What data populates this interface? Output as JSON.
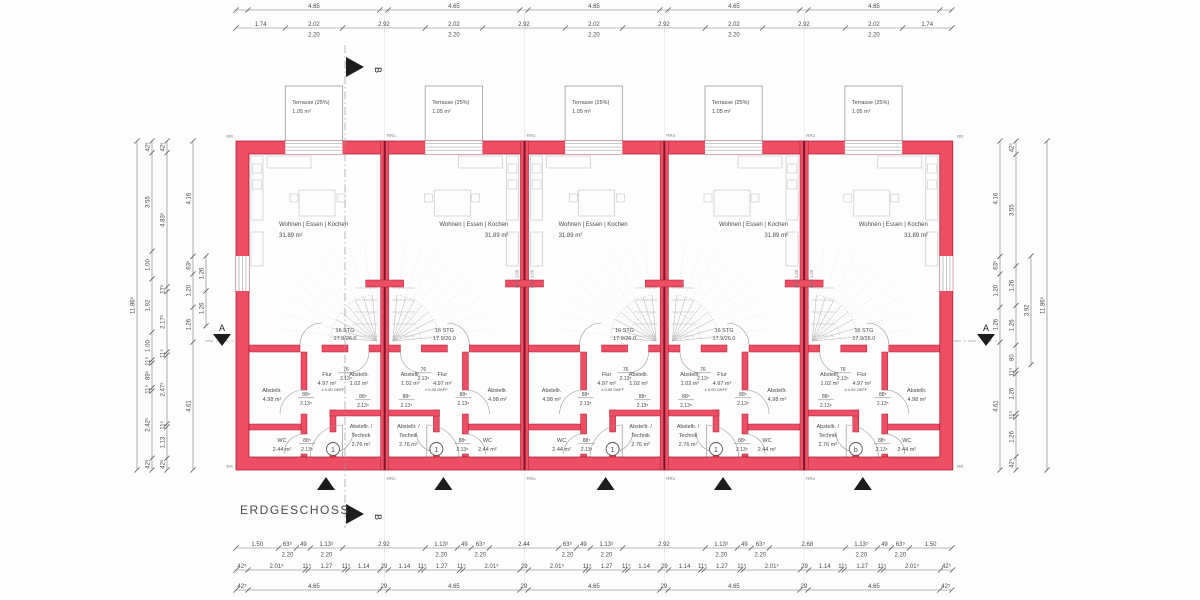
{
  "title": "ERDGESCHOSS",
  "section": {
    "a": "A",
    "b": "B"
  },
  "wall_marks": {
    "corner": "RR",
    "top": "RRo",
    "bottom": "RRu"
  },
  "window_sill": "BRH 1.00",
  "colors": {
    "wall": "#ee4e63",
    "wall_edge": "#a81e33",
    "wall_core": "#7d1427",
    "line": "#8a8a8a",
    "dim": "#4a4a4a",
    "faint": "#e3e3e3",
    "furniture": "#c9c9c9",
    "stair": "#b3b3b3",
    "marker": "#1c1c1c"
  },
  "units": [
    {
      "number": "1",
      "living_label": "Wohnen | Essen | Kochen",
      "living_area": "31.89 m²",
      "terrace_label": "Terrasse (25%)",
      "terrace_area": "1.05 m²",
      "stair_steps": "16 STG",
      "stair_ratio": "17.9/26.0",
      "flur_label": "Flur",
      "flur_area": "4.97 m²",
      "storage_small_label": "Abstellr.",
      "storage_small_area": "1.02 m²",
      "storage_label": "Abstellr.",
      "storage_area": "4.98 m²",
      "wc_label": "WC",
      "wc_area": "2.44 m²",
      "technik_line1": "Abstellr. /",
      "technik_line2": "Technik",
      "technik_area": "2.76 m²",
      "level_tag": "± 0.00 OKFF",
      "door_small_w": "76",
      "door_small_h": "2.13⁵",
      "door_std_w": "88⁵",
      "door_std_h": "2.13⁵"
    },
    {
      "number": "1",
      "living_label": "Wohnen | Essen | Kochen",
      "living_area": "31.89 m²",
      "terrace_label": "Terrasse (25%)",
      "terrace_area": "1.05 m²",
      "stair_steps": "16 STG",
      "stair_ratio": "17.9/26.0",
      "flur_label": "Flur",
      "flur_area": "4.97 m²",
      "storage_small_label": "Abstellr.",
      "storage_small_area": "1.02 m²",
      "storage_label": "Abstellr.",
      "storage_area": "4.98 m²",
      "wc_label": "WC",
      "wc_area": "2.44 m²",
      "technik_line1": "Abstellr. /",
      "technik_line2": "Technik",
      "technik_area": "2.76 m²",
      "level_tag": "± 0.00 OKFF",
      "door_small_w": "76",
      "door_small_h": "2.13⁵",
      "door_std_w": "88⁵",
      "door_std_h": "2.13⁵"
    },
    {
      "number": "1",
      "living_label": "Wohnen | Essen | Kochen",
      "living_area": "31.89 m²",
      "terrace_label": "Terrasse (25%)",
      "terrace_area": "1.05 m²",
      "stair_steps": "16 STG",
      "stair_ratio": "17.9/26.0",
      "flur_label": "Flur",
      "flur_area": "4.97 m²",
      "storage_small_label": "Abstellr.",
      "storage_small_area": "1.02 m²",
      "storage_label": "Abstellr.",
      "storage_area": "4.98 m²",
      "wc_label": "WC",
      "wc_area": "2.44 m²",
      "technik_line1": "Abstellr. /",
      "technik_line2": "Technik",
      "technik_area": "2.76 m²",
      "level_tag": "± 0.00 OKFF",
      "door_small_w": "76",
      "door_small_h": "2.13⁵",
      "door_std_w": "88⁵",
      "door_std_h": "2.13⁵"
    },
    {
      "number": "1",
      "living_label": "Wohnen | Essen | Kochen",
      "living_area": "31.89 m²",
      "terrace_label": "Terrasse (25%)",
      "terrace_area": "1.05 m²",
      "stair_steps": "16 STG",
      "stair_ratio": "17.9/26.0",
      "flur_label": "Flur",
      "flur_area": "4.97 m²",
      "storage_small_label": "Abstellr.",
      "storage_small_area": "1.02 m²",
      "storage_label": "Abstellr.",
      "storage_area": "4.98 m²",
      "wc_label": "WC",
      "wc_area": "2.44 m²",
      "technik_line1": "Abstellr. /",
      "technik_line2": "Technik",
      "technik_area": "2.76 m²",
      "level_tag": "± 0.00 OKFF",
      "door_small_w": "76",
      "door_small_h": "2.13⁵",
      "door_std_w": "88⁵",
      "door_std_h": "2.13⁵"
    },
    {
      "number": "b",
      "living_label": "Wohnen | Essen | Kochen",
      "living_area": "31.89 m²",
      "terrace_label": "Terrasse (25%)",
      "terrace_area": "1.05 m²",
      "stair_steps": "16 STG",
      "stair_ratio": "17.9/26.0",
      "flur_label": "Flur",
      "flur_area": "4.97 m²",
      "storage_small_label": "Abstellr.",
      "storage_small_area": "1.02 m²",
      "storage_label": "Abstellr.",
      "storage_area": "4.98 m²",
      "wc_label": "WC",
      "wc_area": "2.44 m²",
      "technik_line1": "Abstellr. /",
      "technik_line2": "Technik",
      "technik_area": "2.76 m²",
      "level_tag": "± 0.00 OKFF",
      "door_small_w": "76",
      "door_small_h": "2.13⁵",
      "door_std_w": "88⁵",
      "door_std_h": "2.13⁵"
    }
  ],
  "dimensions": {
    "top_outer": [
      {
        "v": "42⁵",
        "hide": true
      },
      {
        "v": "4.65"
      },
      {
        "v": "29",
        "hide": true
      },
      {
        "v": "4.65"
      },
      {
        "v": "29",
        "hide": true
      },
      {
        "v": "4.65"
      },
      {
        "v": "29",
        "hide": true
      },
      {
        "v": "4.65"
      },
      {
        "v": "29",
        "hide": true
      },
      {
        "v": "4.65"
      },
      {
        "v": "42⁵",
        "hide": true
      }
    ],
    "top_inner": [
      {
        "v": "1.74"
      },
      {
        "v": "2.02",
        "sub": "2.20"
      },
      {
        "v": "2.92"
      },
      {
        "v": "2.02",
        "sub": "2.20"
      },
      {
        "v": "2.92"
      },
      {
        "v": "2.02",
        "sub": "2.20"
      },
      {
        "v": "2.92"
      },
      {
        "v": "2.02",
        "sub": "2.20"
      },
      {
        "v": "2.92"
      },
      {
        "v": "2.02",
        "sub": "2.20"
      },
      {
        "v": "1.74"
      }
    ],
    "bottom_win": [
      {
        "v": "1.50"
      },
      {
        "v": "63⁵",
        "sub": "2.20"
      },
      {
        "v": "49"
      },
      {
        "v": "1.13⁵",
        "sub": "2.20"
      },
      {
        "v": "2.92"
      },
      {
        "v": "1.13⁵",
        "sub": "2.20"
      },
      {
        "v": "49"
      },
      {
        "v": "63⁵",
        "sub": "2.20"
      },
      {
        "v": "2.44"
      },
      {
        "v": "63⁵",
        "sub": "2.20"
      },
      {
        "v": "49"
      },
      {
        "v": "1.13⁵",
        "sub": "2.20"
      },
      {
        "v": "2.92"
      },
      {
        "v": "1.13⁵",
        "sub": "2.20"
      },
      {
        "v": "49"
      },
      {
        "v": "63⁵",
        "sub": "2.20"
      },
      {
        "v": "2.68"
      },
      {
        "v": "1.13⁵",
        "sub": "2.20"
      },
      {
        "v": "49"
      },
      {
        "v": "63⁵",
        "sub": "2.20"
      },
      {
        "v": "1.50"
      }
    ],
    "bottom_detail": [
      {
        "v": "42⁵"
      },
      {
        "v": "2.01⁵"
      },
      {
        "v": "11⁵"
      },
      {
        "v": "1.27"
      },
      {
        "v": "11⁵"
      },
      {
        "v": "1.14"
      },
      {
        "v": "29"
      },
      {
        "v": "1.14"
      },
      {
        "v": "11⁵"
      },
      {
        "v": "1.27"
      },
      {
        "v": "11⁵"
      },
      {
        "v": "2.01⁵"
      },
      {
        "v": "29"
      },
      {
        "v": "2.01⁵"
      },
      {
        "v": "11⁵"
      },
      {
        "v": "1.27"
      },
      {
        "v": "11⁵"
      },
      {
        "v": "1.14"
      },
      {
        "v": "29"
      },
      {
        "v": "1.14"
      },
      {
        "v": "11⁵"
      },
      {
        "v": "1.27"
      },
      {
        "v": "11⁵"
      },
      {
        "v": "2.01⁵"
      },
      {
        "v": "29"
      },
      {
        "v": "1.14"
      },
      {
        "v": "11⁵"
      },
      {
        "v": "1.27"
      },
      {
        "v": "11⁵"
      },
      {
        "v": "2.01⁵"
      },
      {
        "v": "42⁵"
      }
    ],
    "bottom_axis": [
      {
        "v": "42⁵"
      },
      {
        "v": "4.65"
      },
      {
        "v": "29"
      },
      {
        "v": "4.65"
      },
      {
        "v": "29"
      },
      {
        "v": "4.65"
      },
      {
        "v": "29"
      },
      {
        "v": "4.65"
      },
      {
        "v": "29"
      },
      {
        "v": "4.65"
      },
      {
        "v": "42⁵"
      }
    ],
    "left_total": [
      {
        "v": "11.86⁵"
      }
    ],
    "left_c1": [
      {
        "v": "42⁵"
      },
      {
        "v": "3.55"
      },
      {
        "v": "1.00"
      },
      {
        "v": "1.92"
      },
      {
        "v": "1.00"
      },
      {
        "v": "11⁵"
      },
      {
        "v": "89⁵"
      },
      {
        "v": "11⁵"
      },
      {
        "v": "2.42⁵"
      },
      {
        "v": "42⁵"
      }
    ],
    "left_c2": [
      {
        "v": "42⁵"
      },
      {
        "v": "4.83⁵"
      },
      {
        "v": "17⁵"
      },
      {
        "v": "2.17⁵"
      },
      {
        "v": "11⁵"
      },
      {
        "v": "2.47⁵"
      },
      {
        "v": "11⁵"
      },
      {
        "v": "1.13"
      },
      {
        "v": "42⁵"
      }
    ],
    "left_c3": [
      {
        "v": "4.16"
      },
      {
        "v": "63⁵"
      },
      {
        "v": "1.20"
      },
      {
        "v": "1.26"
      },
      {
        "v": "4.61"
      }
    ],
    "left_c4": [
      {
        "v": "1.26"
      },
      {
        "v": "1.26"
      }
    ],
    "right_c1": [
      {
        "v": "4.16"
      },
      {
        "v": "63⁵"
      },
      {
        "v": "1.20"
      },
      {
        "v": "1.26"
      },
      {
        "v": "4.61"
      }
    ],
    "right_c2": [
      {
        "v": "42⁵"
      },
      {
        "v": "3.55"
      },
      {
        "v": "1.26"
      },
      {
        "v": "1.26"
      },
      {
        "v": "80"
      },
      {
        "v": "11⁵"
      },
      {
        "v": "1.26"
      },
      {
        "v": "11⁵"
      },
      {
        "v": "1.26"
      },
      {
        "v": "42⁵"
      }
    ],
    "right_c3": [
      {
        "v": "3.92"
      }
    ],
    "right_total": [
      {
        "v": "11.86⁵"
      }
    ]
  }
}
